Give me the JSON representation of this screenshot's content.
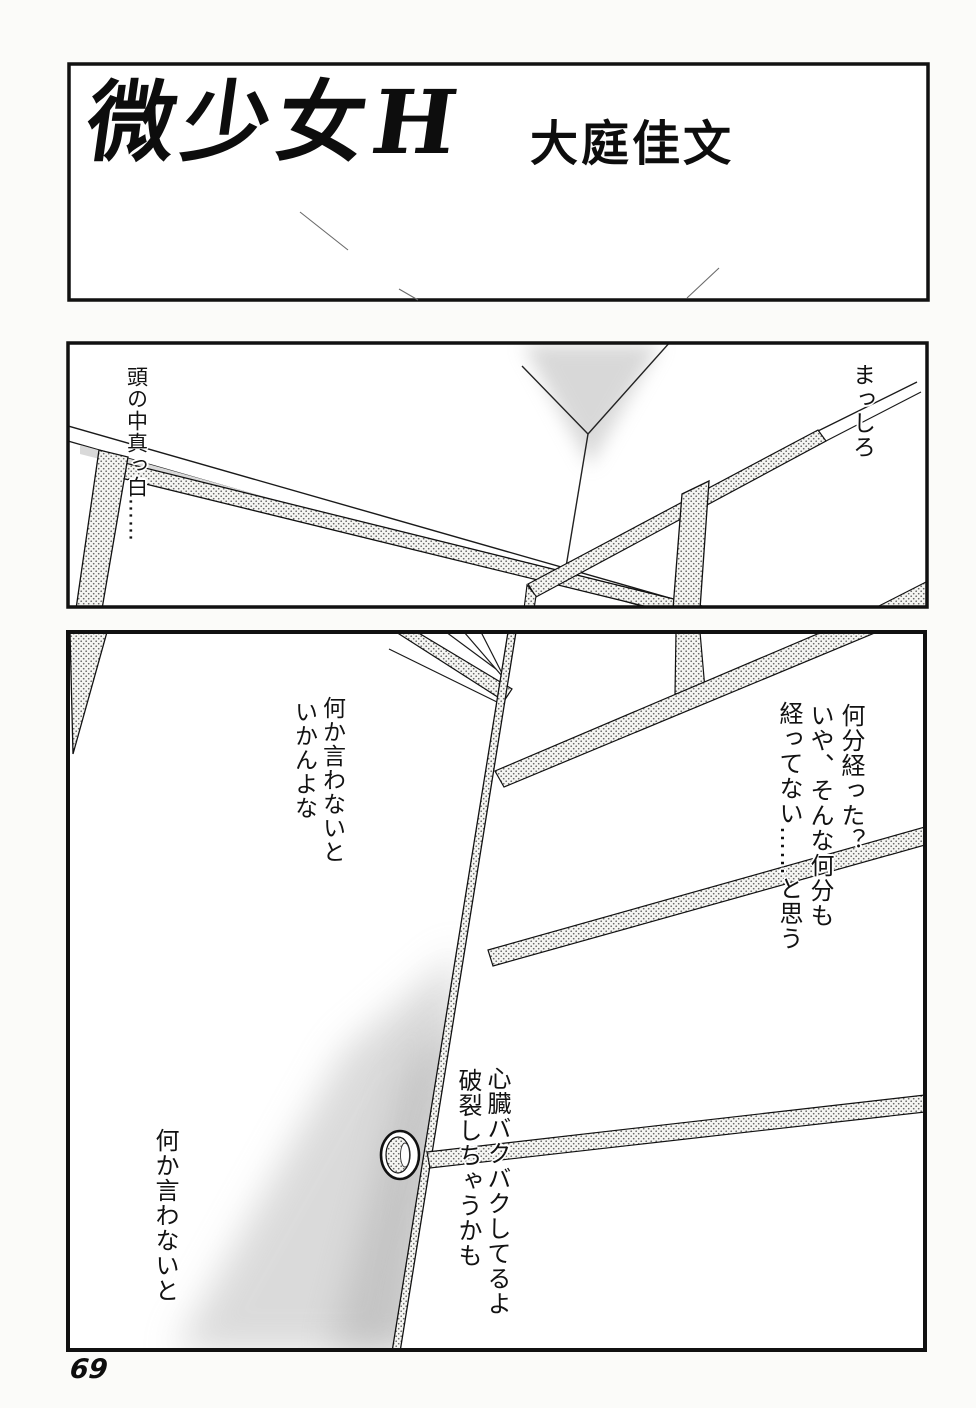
{
  "page": {
    "number": "69"
  },
  "title_panel": {
    "title": "微少女H",
    "author": "大庭佳文"
  },
  "middle_panel": {
    "thought_left": "頭の中真っ白……",
    "thought_right": "まっしろ"
  },
  "bottom_panel": {
    "monologue_upper_left": [
      "何か言わないと",
      "いかんよな"
    ],
    "monologue_right": [
      "何分経った？",
      "いや、そんな何分も",
      "経ってない……と思う"
    ],
    "monologue_center": [
      "心臓バクバクしてるよ",
      "破裂しちゃうかも"
    ],
    "monologue_lower_left": "何か言わないと"
  },
  "colors": {
    "ink": "#111111",
    "paper": "#fbfbf9",
    "tone_dot": "#666666",
    "tone_strip": "#d9d9d9"
  }
}
